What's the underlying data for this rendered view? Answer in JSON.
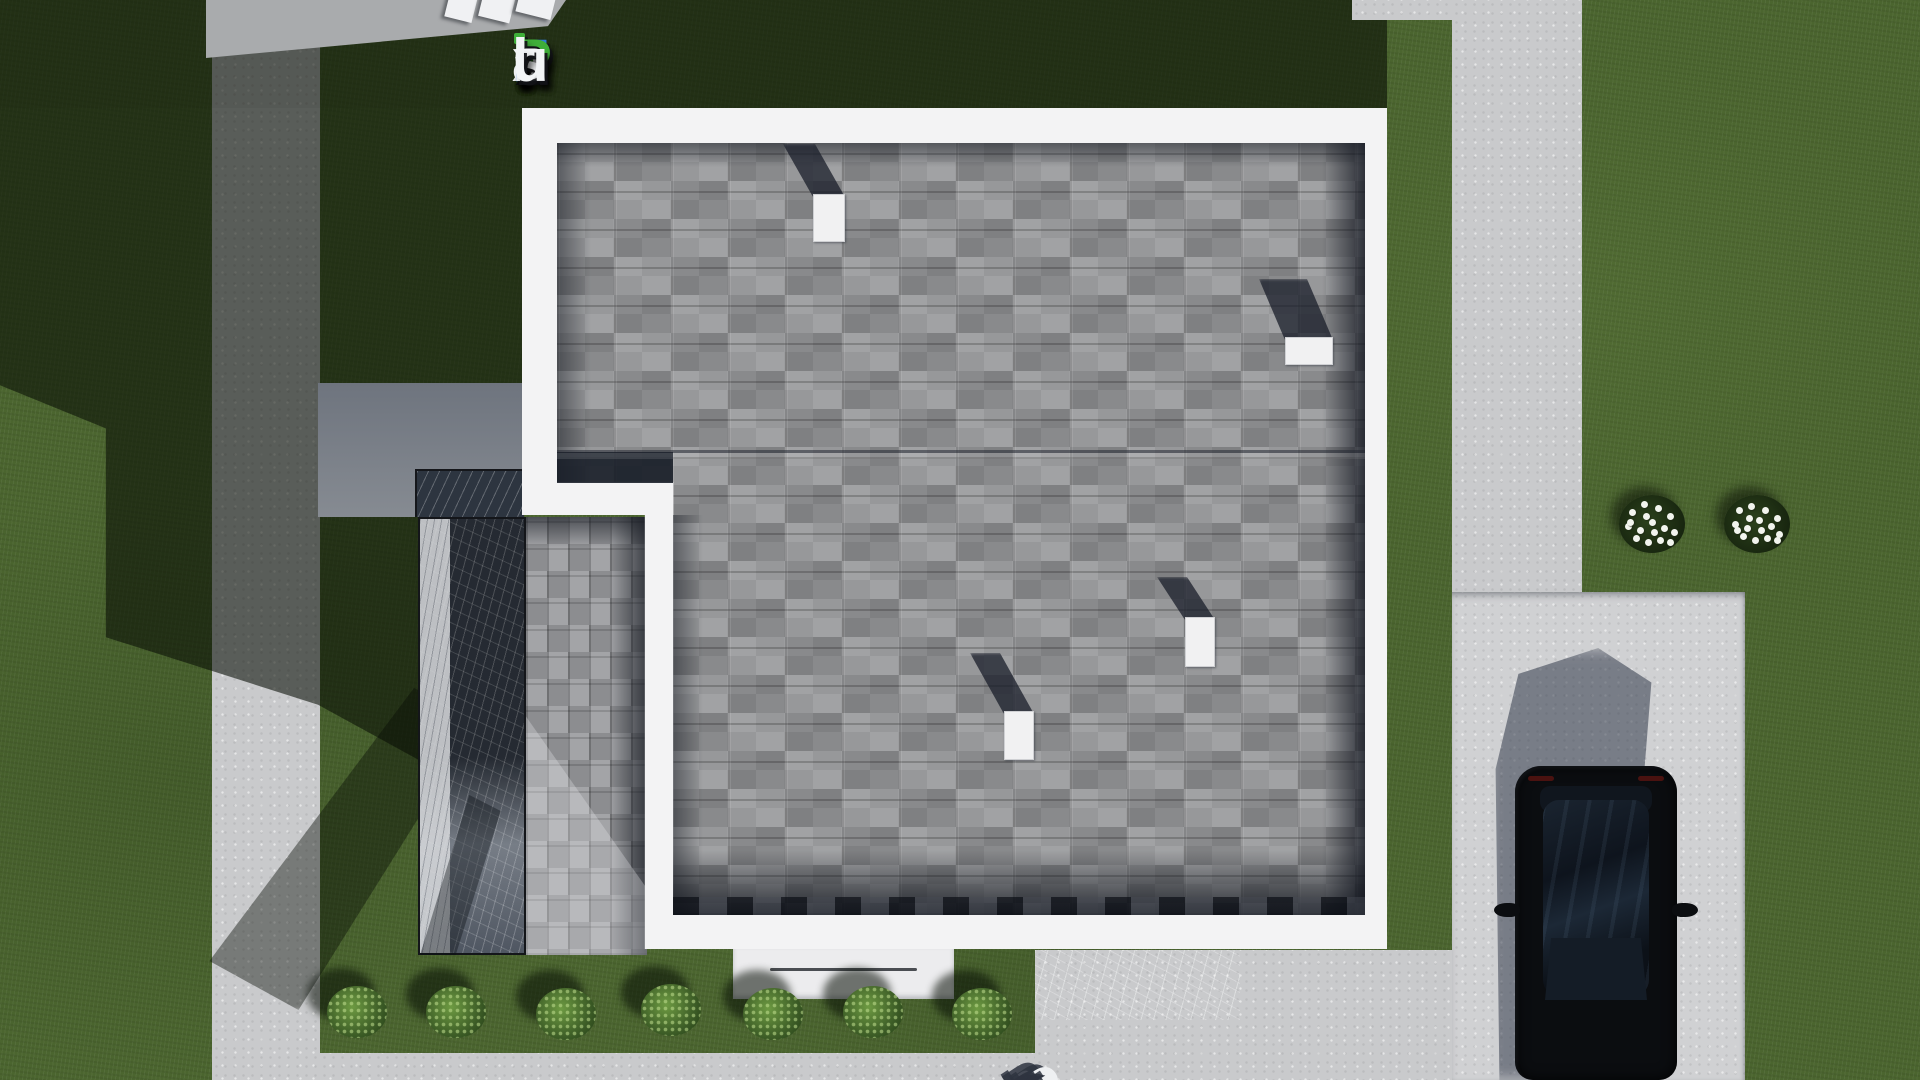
{
  "watermarks": {
    "logo": {
      "text": "FixPlans.ru",
      "segments": [
        {
          "t": "F",
          "c": "#2e7cd9"
        },
        {
          "t": "ı",
          "c": "#f2f4f6",
          "dot": "#3fae39"
        },
        {
          "t": "x",
          "c": "#f2f4f6"
        },
        {
          "t": "P",
          "c": "#3fae39"
        },
        {
          "t": "l",
          "c": "#f2f4f6"
        },
        {
          "t": "a",
          "c": "#f2f4f6"
        },
        {
          "t": "n",
          "c": "#f2f4f6"
        },
        {
          "t": "s",
          "c": "#f2f4f6"
        },
        {
          "t": ".",
          "c": "#2e7cd9"
        },
        {
          "t": "r",
          "c": "#f2f4f6"
        },
        {
          "t": "u",
          "c": "#f2f4f6"
        }
      ]
    },
    "ground": {
      "text": "Plans.ru",
      "segments": [
        {
          "t": "P",
          "c": "#eef0f2"
        },
        {
          "t": "l",
          "c": "#eef0f2"
        },
        {
          "t": "a",
          "c": "#eef0f2"
        },
        {
          "t": "n",
          "c": "#eef0f2"
        },
        {
          "t": "s",
          "c": "#eef0f2"
        },
        {
          "t": ".",
          "c": "#1e9fd8"
        },
        {
          "t": "r",
          "c": "#eef0f2"
        },
        {
          "t": "u",
          "c": "#eef0f2"
        }
      ]
    },
    "top_partial_blocks": [
      {
        "x": 447,
        "y": -6,
        "w": 28,
        "h": 26,
        "rot": 14
      },
      {
        "x": 481,
        "y": -8,
        "w": 32,
        "h": 28,
        "rot": 14
      },
      {
        "x": 518,
        "y": -10,
        "w": 36,
        "h": 26,
        "rot": 14
      }
    ]
  },
  "palette": {
    "grass": "#4b652f",
    "grass_shadow": "#1c2a16",
    "concrete": "#c9cacc",
    "roof_shingle": "#9a9b9d",
    "house_trim": "#f3f3f4",
    "logo_blue": "#2e7cd9",
    "logo_green": "#3fae39",
    "watermark_dot_blue": "#1e9fd8",
    "car_body": "#0b0d10"
  },
  "scene": {
    "description": "Top-down 3D render of a house roof plan with lawn, concrete paths, driveway with parked black car, stone terrace, hedge row and flower beds",
    "roof_vents": [
      {
        "x": 813,
        "y": 194,
        "w": 32,
        "h": 48,
        "sx": 30,
        "sy": 50
      },
      {
        "x": 1285,
        "y": 337,
        "w": 48,
        "h": 28,
        "sx": 26,
        "sy": 58
      },
      {
        "x": 1185,
        "y": 617,
        "w": 30,
        "h": 50,
        "sx": 28,
        "sy": 40
      },
      {
        "x": 1004,
        "y": 711,
        "w": 30,
        "h": 49,
        "sx": 34,
        "sy": 58
      }
    ],
    "bushes": [
      {
        "cx": 357,
        "cy": 1012
      },
      {
        "cx": 456,
        "cy": 1012
      },
      {
        "cx": 566,
        "cy": 1014
      },
      {
        "cx": 671,
        "cy": 1010
      },
      {
        "cx": 773,
        "cy": 1014
      },
      {
        "cx": 873,
        "cy": 1012
      },
      {
        "cx": 982,
        "cy": 1014
      }
    ],
    "bush_size": {
      "w": 60,
      "h": 52
    },
    "flower_clusters": [
      {
        "cx": 1652,
        "cy": 524,
        "dots": [
          [
            -20,
            -12
          ],
          [
            -8,
            -20
          ],
          [
            6,
            -16
          ],
          [
            18,
            -8
          ],
          [
            -24,
            2
          ],
          [
            -12,
            6
          ],
          [
            0,
            -2
          ],
          [
            12,
            4
          ],
          [
            22,
            8
          ],
          [
            -16,
            14
          ],
          [
            -4,
            18
          ],
          [
            8,
            16
          ],
          [
            18,
            18
          ],
          [
            -22,
            -2
          ],
          [
            2,
            8
          ],
          [
            -6,
            -8
          ]
        ]
      },
      {
        "cx": 1757,
        "cy": 524,
        "dots": [
          [
            -18,
            -14
          ],
          [
            -6,
            -18
          ],
          [
            8,
            -14
          ],
          [
            20,
            -6
          ],
          [
            -22,
            0
          ],
          [
            -10,
            4
          ],
          [
            2,
            -4
          ],
          [
            14,
            2
          ],
          [
            22,
            10
          ],
          [
            -14,
            12
          ],
          [
            -2,
            16
          ],
          [
            10,
            14
          ],
          [
            20,
            16
          ],
          [
            -20,
            6
          ],
          [
            4,
            6
          ],
          [
            -8,
            -6
          ]
        ]
      }
    ],
    "flower_base_size": {
      "w": 66,
      "h": 58
    }
  }
}
